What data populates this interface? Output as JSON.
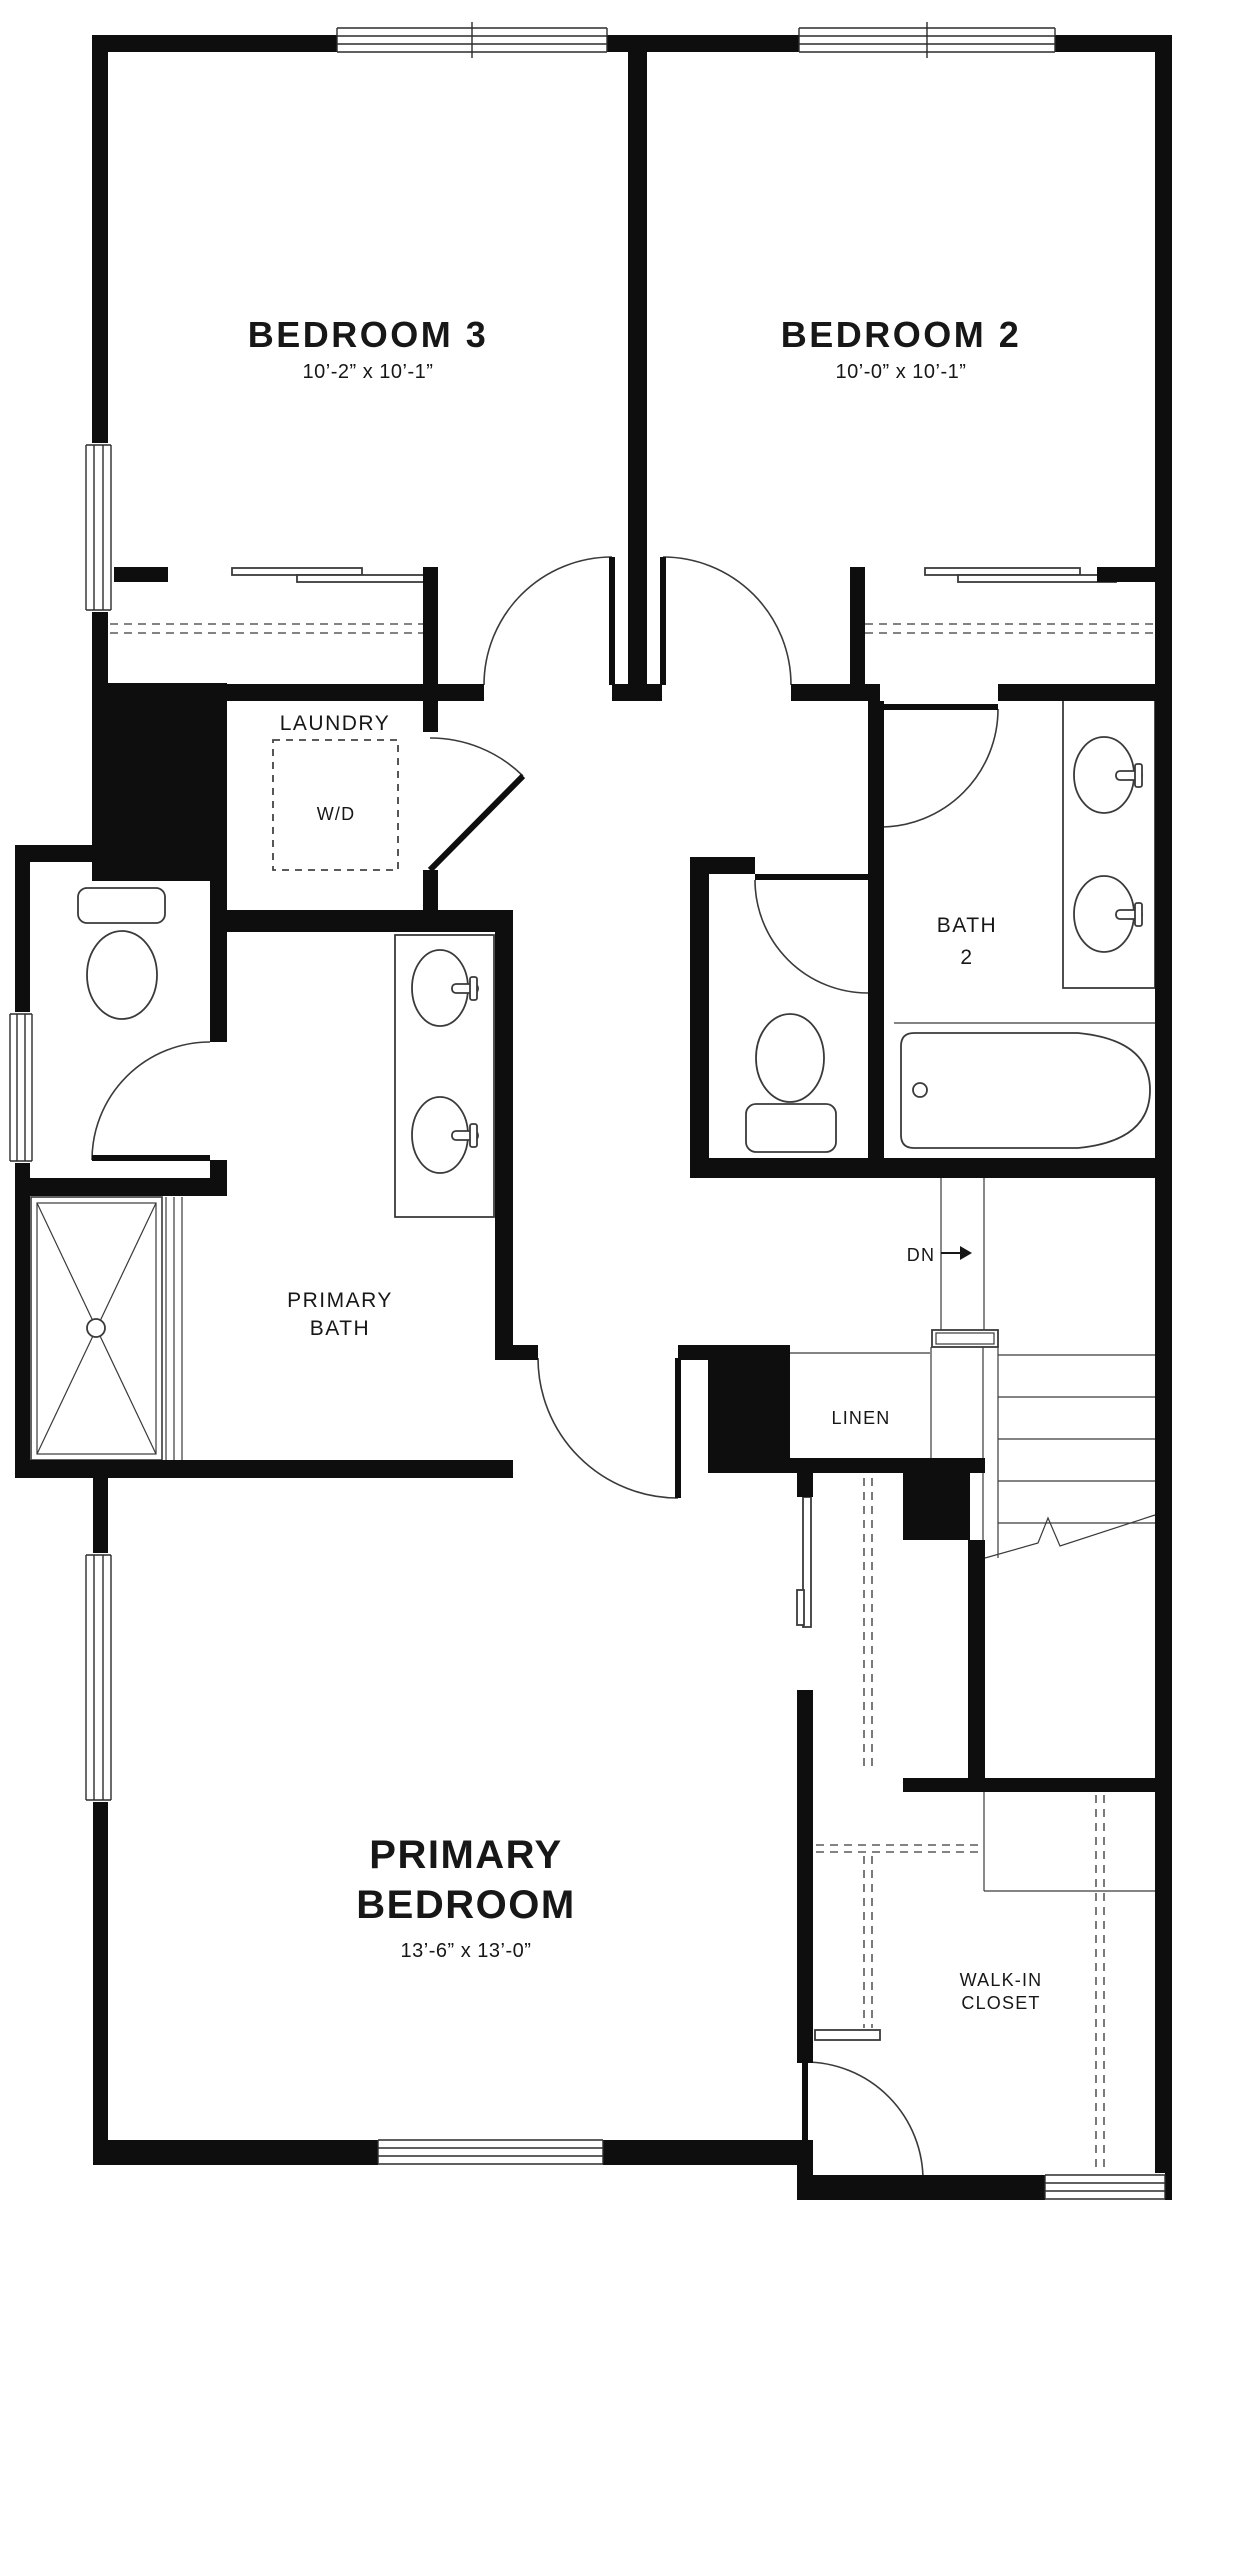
{
  "colors": {
    "wall": "#0e0e0e",
    "line": "#3a3a3a",
    "dashed": "#5a5a5a",
    "text": "#171717",
    "background": "#ffffff"
  },
  "rooms": {
    "bedroom3": {
      "name": "BEDROOM 3",
      "dims": "10’-2” x 10’-1”"
    },
    "bedroom2": {
      "name": "BEDROOM 2",
      "dims": "10’-0” x 10’-1”"
    },
    "laundry": {
      "name": "LAUNDRY",
      "appliance": "W/D"
    },
    "bath2": {
      "name_line1": "BATH",
      "name_line2": "2"
    },
    "primary_bath": {
      "name_line1": "PRIMARY",
      "name_line2": "BATH"
    },
    "linen": {
      "name": "LINEN"
    },
    "stairs": {
      "direction": "DN"
    },
    "primary_bedroom": {
      "name_line1": "PRIMARY",
      "name_line2": "BEDROOM",
      "dims": "13’-6” x 13’-0”"
    },
    "walk_in_closet": {
      "name_line1": "WALK-IN",
      "name_line2": "CLOSET"
    }
  }
}
